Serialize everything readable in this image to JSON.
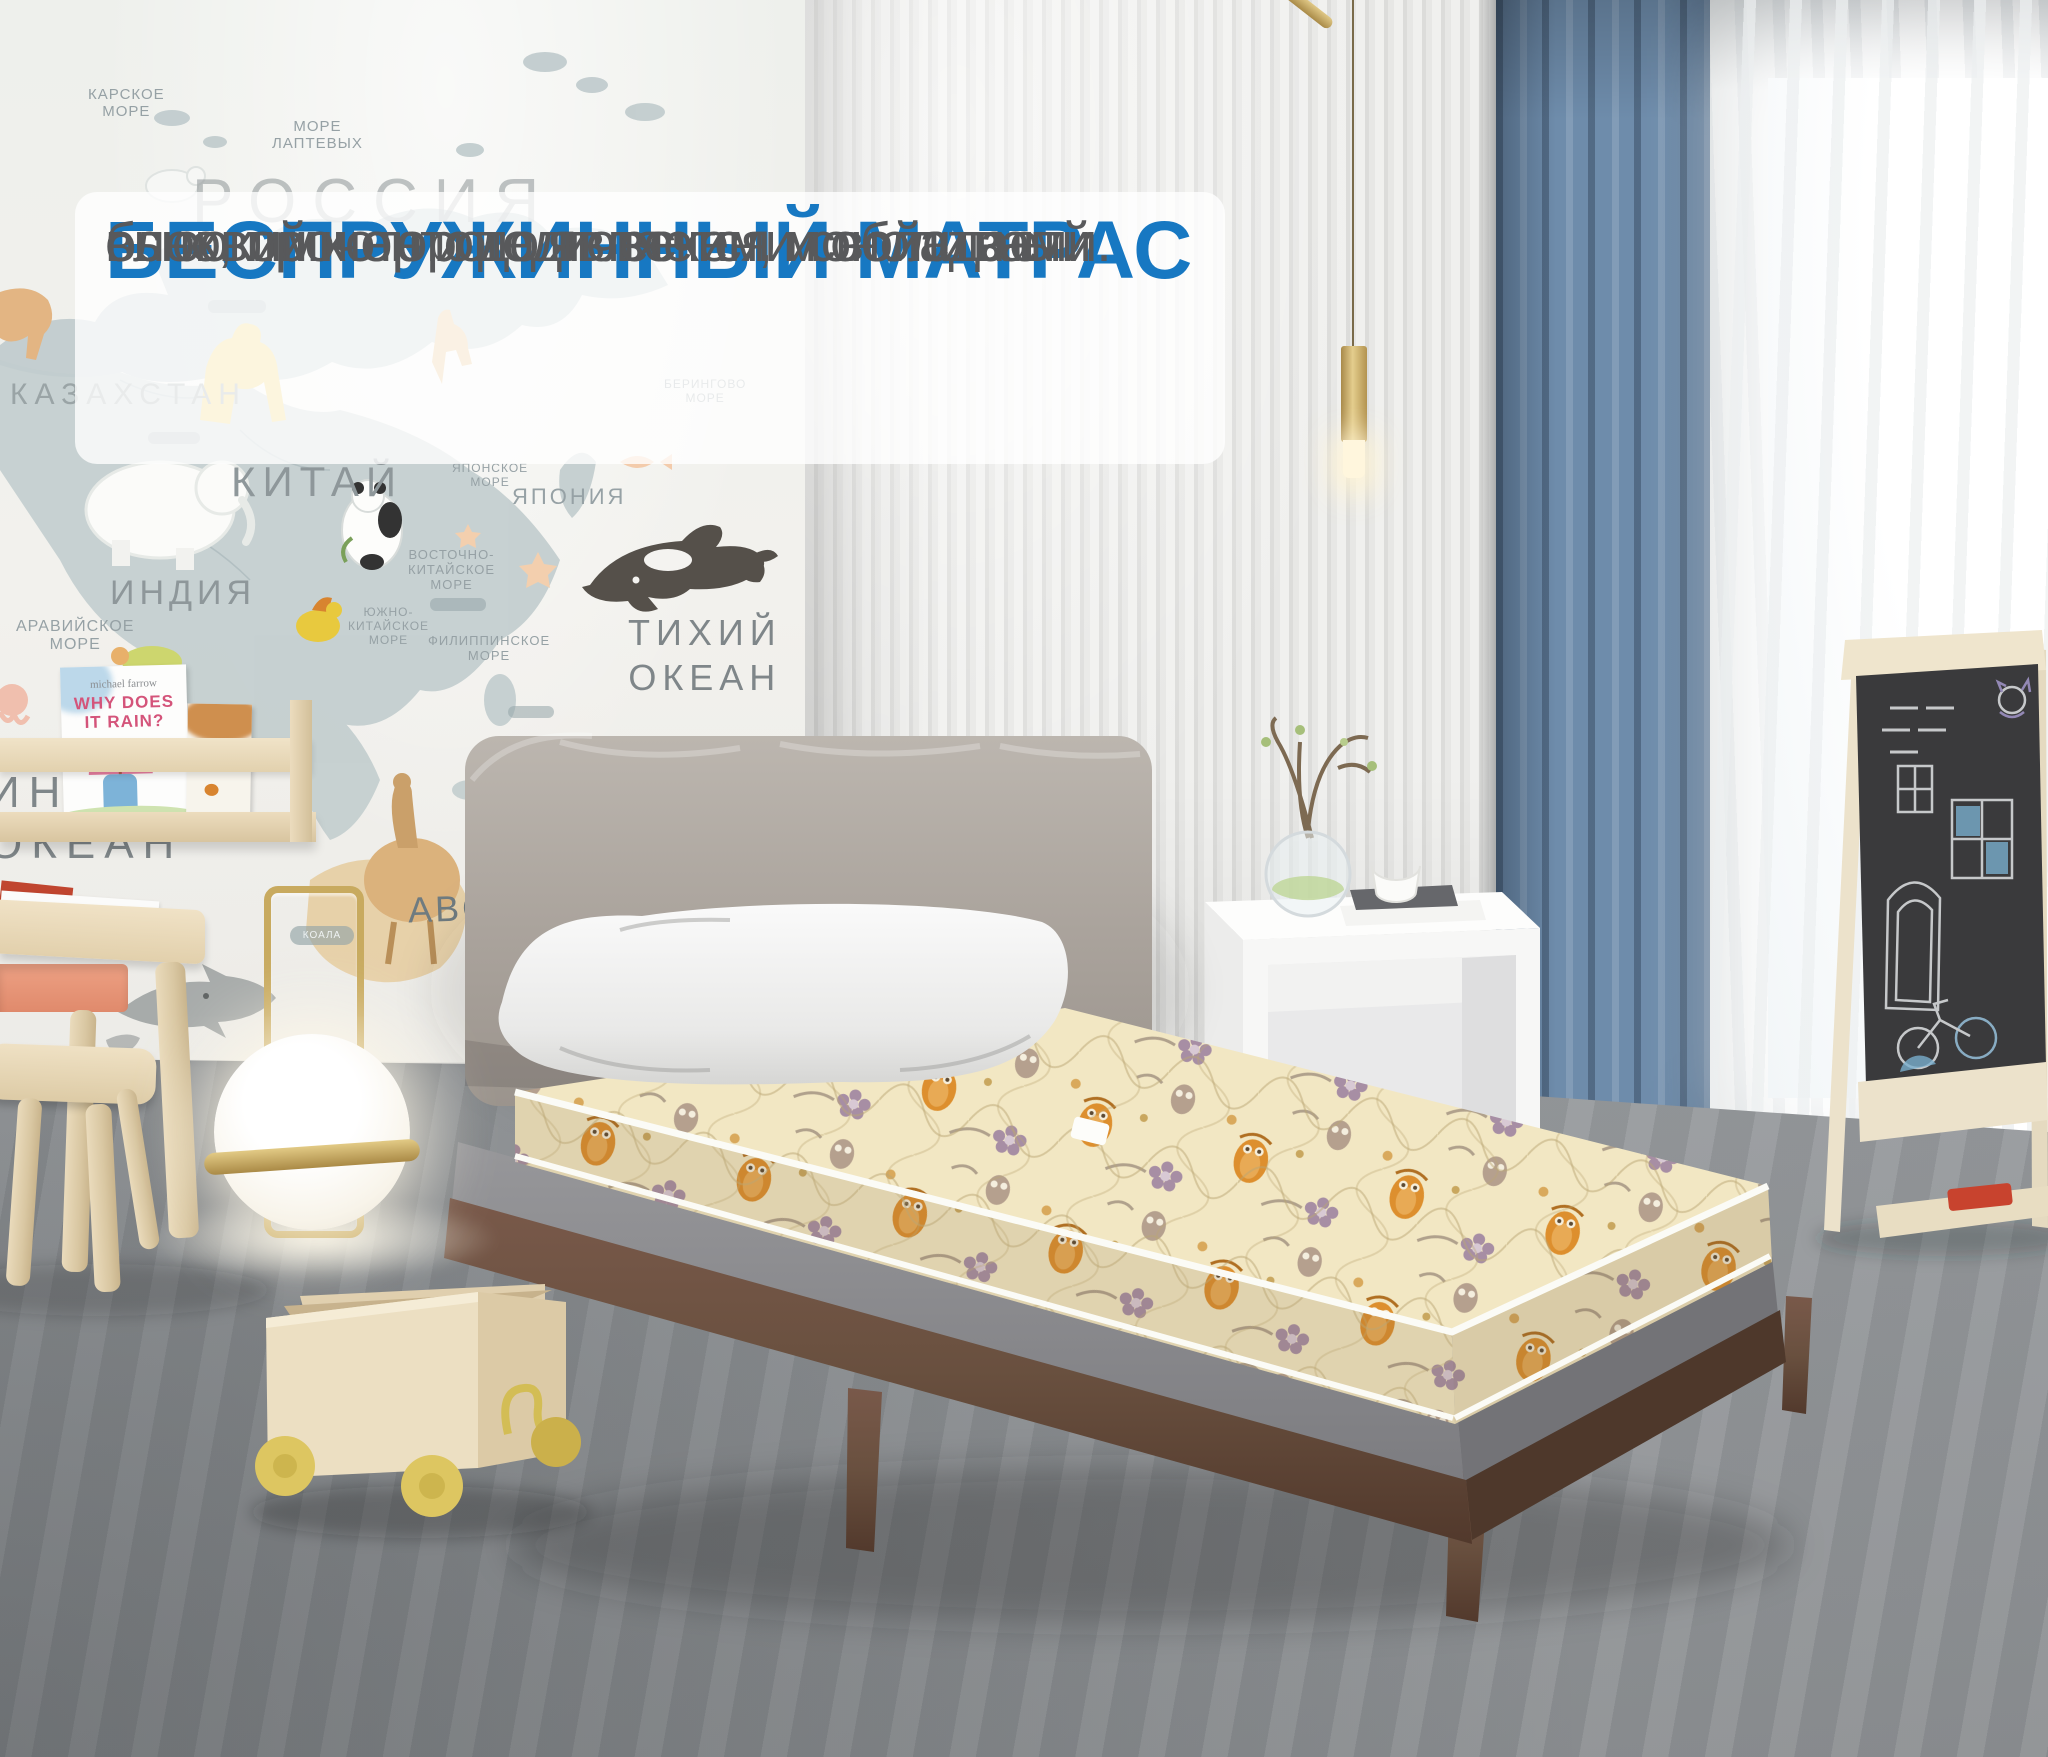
{
  "overlay": {
    "title": "БЕСПРУЖИННЫЙ МАТРАС",
    "body_line1": "основой которого является монолитный",
    "body_line2": "блок, прочен и долговечен, и обладает",
    "body_line3": "высокими ортопедическими свойствами."
  },
  "map": {
    "labels": {
      "karskoe": "КАРСКОЕ\nМОРЕ",
      "laptevyh": "МОРЕ\nЛАПТЕВЫХ",
      "rossiya": "РОССИЯ",
      "kazahstan": "КАЗАХСТАН",
      "kitay": "КИТАЙ",
      "indiya": "ИНДИЯ",
      "aravijskoe": "АРАВИЙСКОЕ\nМОРЕ",
      "yaponiya": "ЯПОНИЯ",
      "yaponskoe": "ЯПОНСКОЕ\nМОРЕ",
      "beringovo": "БЕРИНГОВО\nМОРЕ",
      "vostochno_kitayskoe": "ВОСТОЧНО-\nКИТАЙСКОЕ\nМОРЕ",
      "yuzhno_kitayskoe": "ЮЖНО-\nКИТАЙСКОЕ\nМОРЕ",
      "filippinskoe": "ФИЛИППИНСКОЕ\nМОРЕ",
      "tihiy_okean": "ТИХИЙ\nОКЕАН",
      "indiyskiy_okean": "ИНДИЙСКИЙ\nОКЕАН",
      "abc": "ABC",
      "koala": "КОАЛА"
    }
  },
  "shelf_books": {
    "book1_author": "michael farrow",
    "book1_title": "WHY DOES\nIT RAIN?",
    "book2_title": "gratch",
    "book2_subtitle": "of butterfly"
  },
  "colors": {
    "accent_blue": "#1778c2",
    "overlay_body_gray": "#58595b",
    "curtain_blue": "#6e8cab",
    "mattress_cream": "#f2e7c3",
    "mattress_owl_orange": "#dd8f2e",
    "wood_walnut": "#6b4f3f",
    "brass": "#c8aa5f",
    "floor_gray": "#9a9da0"
  }
}
